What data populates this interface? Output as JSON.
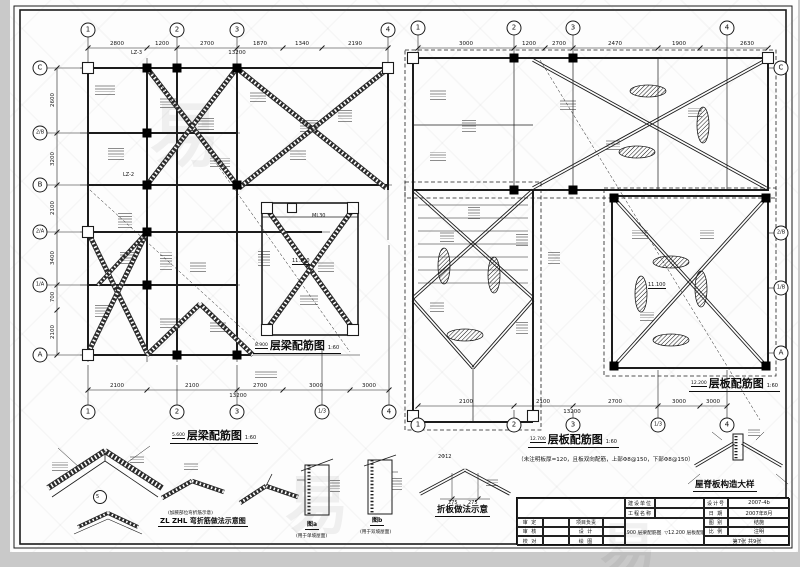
{
  "plans": {
    "left_beam": {
      "caption_mid": {
        "elev": "8.900",
        "title": "层梁配筋图",
        "scale": "1:60"
      },
      "caption_bottom": {
        "elev": "5.600",
        "title": "层梁配筋图",
        "scale": "1:60"
      },
      "axes_top": [
        "1",
        "2",
        "3",
        "4"
      ],
      "axes_bottom": [
        "1",
        "2",
        "3",
        "1/3",
        "4"
      ],
      "axes_side": [
        "C",
        "2/B",
        "B",
        "2/A",
        "1/A",
        "A"
      ],
      "dims_top": [
        "2800",
        "1200",
        "2700",
        "1870",
        "1340",
        "2190"
      ],
      "dims_top_total": "13200",
      "dims_bottom": [
        "2100",
        "2100",
        "2700",
        "3000",
        "3000"
      ],
      "dims_bottom_total": "13200",
      "dims_side": [
        "2600",
        "3200",
        "2100",
        "3400",
        "700",
        "2100"
      ],
      "col_label_1": "LZ-3",
      "col_label_2": "LZ-2",
      "beam_label": "ML30",
      "elev_label": "11.100"
    },
    "right_slab": {
      "caption_mid": {
        "elev": "12.200",
        "title": "层板配筋图",
        "scale": "1:60"
      },
      "caption_bottom": {
        "elev": "12.700",
        "title": "层板配筋图",
        "scale": "1:60"
      },
      "note": "（未注明板厚=120，且板双向配筋，上部Φ8@150，下部Φ8@150）",
      "axes_top": [
        "1",
        "2",
        "3",
        "4"
      ],
      "axes_bottom": [
        "1",
        "2",
        "3",
        "1/3",
        "4"
      ],
      "axes_side": [
        "C",
        "2/B",
        "1/B",
        "A"
      ],
      "dims_top": [
        "3000",
        "1200",
        "2700",
        "2470",
        "1900",
        "2630"
      ],
      "dims_bottom": [
        "2100",
        "2100",
        "2700",
        "3000",
        "3000"
      ],
      "dims_bottom_total": "13200",
      "elev_label": "11.100"
    }
  },
  "details": {
    "ridge_node_ref": "5",
    "zl_note": "(加腋部位弯折筋示意)",
    "zl_caption": "ZL ZHL 弯折筋做法示意图",
    "fig_a": {
      "label": "图a",
      "sub": "(用于单坡屋面)"
    },
    "fig_b": {
      "label": "图b",
      "sub": "(用于双坡屋面)"
    },
    "fold_caption": "折板做法示意",
    "fold_bar": "2Φ12",
    "fold_dim_left": "275",
    "fold_dim_right": "275",
    "ridge_slab_caption": "屋脊板构造大样"
  },
  "title_block": {
    "owner_label": "建设单位",
    "project_label": "工程名称",
    "design_no_label": "设计号",
    "design_no": "2007-4b",
    "date_label": "日 期",
    "date": "2007年8月",
    "sheet_type_label": "图 别",
    "sheet_type": "结施",
    "scale_label": "比 例",
    "scale": "注明",
    "sheet_no": "第7张 共9张",
    "row_approve_label": "审 定",
    "row_lead_label": "项目负责",
    "row_check_label": "审 核",
    "row_design_label": "设 计",
    "row_proof_label": "校 对",
    "row_draw_label": "绘 图",
    "content1": {
      "elev": "8.900",
      "name": "层梁配筋图"
    },
    "content2": {
      "elev": "12.200",
      "name": "层板配筋图"
    }
  },
  "watermark": {
    "glyph": "易"
  },
  "colors": {
    "line": "#1c1c1c",
    "sheet": "#fdfdfd"
  }
}
